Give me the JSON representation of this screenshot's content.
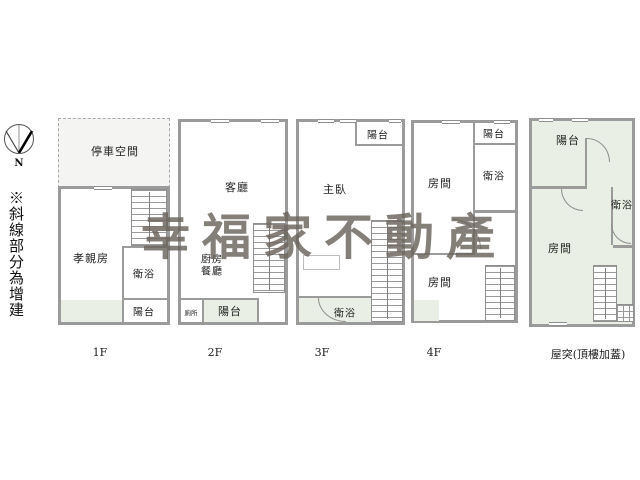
{
  "watermark": {
    "text": "幸福家不動產"
  },
  "legend": {
    "side_note": "※斜線部分為增建"
  },
  "compass": {
    "north": "N"
  },
  "colors": {
    "wall": "#9b9b9b",
    "addition_tint": "#e9efe4",
    "parking_fill": "#f4f4f2",
    "watermark": "#6b635c"
  },
  "floors": [
    {
      "label": "1F",
      "rooms": {
        "parking": "停車空間",
        "parent": "孝親房",
        "bath": "衛浴",
        "balcony": "陽台"
      }
    },
    {
      "label": "2F",
      "rooms": {
        "living": "客廳",
        "kitchen": "廚房",
        "dining": "餐廳",
        "toilet": "廁所",
        "balcony": "陽台"
      }
    },
    {
      "label": "3F",
      "rooms": {
        "balcony": "陽台",
        "master": "主臥",
        "bath": "衛浴"
      }
    },
    {
      "label": "4F",
      "rooms": {
        "balcony": "陽台",
        "bath": "衛浴",
        "room_front": "房間",
        "room_back": "房間"
      }
    },
    {
      "label": "屋突(頂樓加蓋)",
      "rooms": {
        "balcony": "陽台",
        "bath": "衛浴",
        "room": "房間"
      }
    }
  ]
}
